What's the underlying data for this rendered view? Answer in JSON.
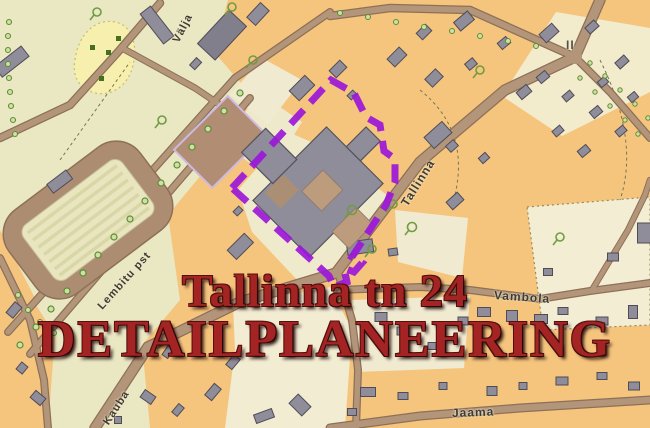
{
  "title": {
    "line1": "Tallinna tn 24",
    "line2": "DETAILPLANEERING",
    "color": "#a32422"
  },
  "boundary": {
    "color": "#9b17d9",
    "style": "dashed"
  },
  "streets": {
    "valja": "Välja",
    "tallinna": "Tallinna",
    "lembitu": "Lembitu pst",
    "vambola": "Vambola",
    "kauba": "Kauba",
    "jaama": "Jaama"
  },
  "markings": {
    "storeys": "II"
  },
  "map_colors": {
    "block_orange": "#f5c57d",
    "open_pale": "#eae7c3",
    "cream_parcel": "#f2eccd",
    "yellow_patch": "#f7efad",
    "road_brown": "#b3957a",
    "road_casing": "#8d7058",
    "building_gray": "#8f8d9a",
    "courtyard_tan": "#bd9b7d",
    "tree_green": "#6f9c42"
  }
}
